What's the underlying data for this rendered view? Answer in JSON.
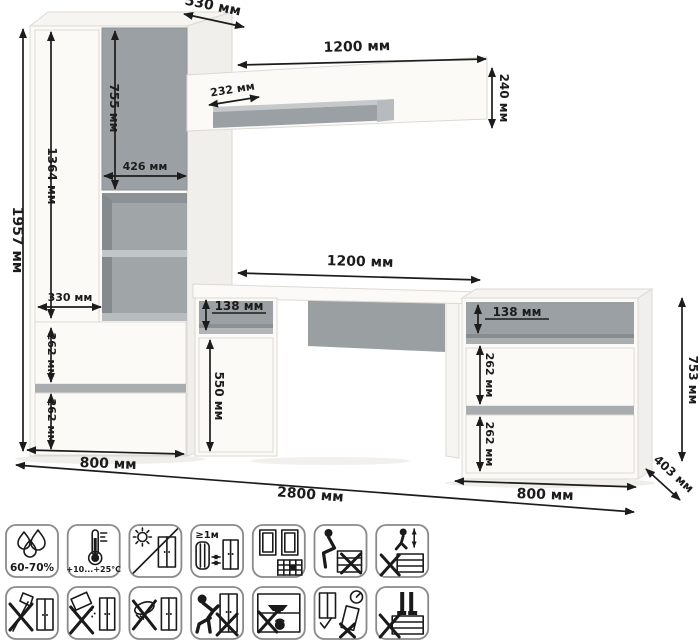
{
  "illustration": {
    "description": "furniture-set-dimension-diagram",
    "colors": {
      "accent_gray": "#9aa0a3",
      "strip_gray": "#a9adaf",
      "furniture_white": "#fbfaf7",
      "line_color": "#1c1c1c"
    }
  },
  "dims": {
    "d530": "530 мм",
    "d1200_shelf": "1200 мм",
    "d232": "232 мм",
    "d240": "240 мм",
    "d1957": "1957 мм",
    "d1364": "1364 мм",
    "d755": "755 мм",
    "d426": "426 мм",
    "d330": "330 мм",
    "d262_w1": "262 мм",
    "d262_w2": "262 мм",
    "d1200_desk": "1200 мм",
    "d138_desk": "138 мм",
    "d550": "550 мм",
    "d138_chest": "138 мм",
    "d262_c1": "262 мм",
    "d262_c2": "262 мм",
    "d753": "753 мм",
    "d800_left": "800 мм",
    "d2800": "2800 мм",
    "d800_right": "800 мм",
    "d403": "403 мм"
  },
  "icons": {
    "row1": [
      {
        "name": "humidity",
        "label": "60-70%"
      },
      {
        "name": "temperature",
        "label": "+10...+25°C"
      },
      {
        "name": "no-direct-sunlight",
        "label": ""
      },
      {
        "name": "heat-source-distance",
        "label": "≥1м"
      },
      {
        "name": "ventilation",
        "label": ""
      },
      {
        "name": "no-sitting",
        "label": ""
      },
      {
        "name": "no-jumping",
        "label": ""
      }
    ],
    "row2": [
      {
        "name": "no-sharp-tools",
        "label": ""
      },
      {
        "name": "no-abrasive-cleaners",
        "label": ""
      },
      {
        "name": "no-wet-cleaning",
        "label": ""
      },
      {
        "name": "no-pushing",
        "label": ""
      },
      {
        "name": "no-overloading",
        "label": ""
      },
      {
        "name": "mounting-level",
        "label": ""
      },
      {
        "name": "no-standing-on-drawers",
        "label": ""
      }
    ]
  }
}
